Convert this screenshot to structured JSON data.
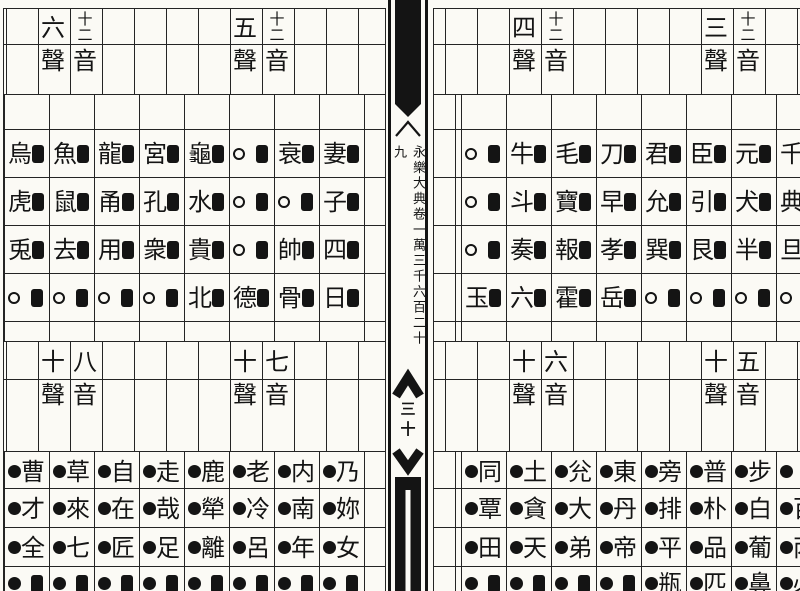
{
  "spine": {
    "volume_title": "永樂大典卷一萬三千六百二十九",
    "page_number": "三十"
  },
  "tables": [
    {
      "id": "sheng3",
      "quadrant": "top-far-right",
      "header_right": "十二音",
      "header_left": "三聲",
      "rows": [
        [
          "君■",
          "臣■",
          "元■",
          "千■"
        ],
        [
          "允■",
          "引■",
          "犬■",
          "典■"
        ],
        [
          "巽■",
          "艮■",
          "半■",
          "旦■"
        ],
        [
          "○■",
          "○■",
          "○■",
          "○■"
        ]
      ]
    },
    {
      "id": "sheng4",
      "quadrant": "top-mid-right",
      "header_right": "十二音",
      "header_left": "四聲",
      "rows": [
        [
          "○■",
          "牛■",
          "毛■",
          "刀■"
        ],
        [
          "○■",
          "斗■",
          "寶■",
          "早■"
        ],
        [
          "○■",
          "奏■",
          "報■",
          "孝■"
        ],
        [
          "玉■",
          "六■",
          "霍■",
          "岳■"
        ]
      ]
    },
    {
      "id": "sheng5",
      "quadrant": "top-mid-left",
      "header_right": "十二音",
      "header_left": "五聲",
      "rows": [
        [
          "龜■",
          "○■",
          "衰■",
          "妻■"
        ],
        [
          "水■",
          "○■",
          "○■",
          "子■"
        ],
        [
          "貴■",
          "○■",
          "帥■",
          "四■"
        ],
        [
          "北■",
          "德■",
          "骨■",
          "日■"
        ]
      ]
    },
    {
      "id": "sheng6",
      "quadrant": "top-far-left",
      "header_right": "十二音",
      "header_left": "六聲",
      "rows": [
        [
          "烏■",
          "魚■",
          "龍■",
          "宮■"
        ],
        [
          "虎■",
          "鼠■",
          "甬■",
          "孔■"
        ],
        [
          "兎■",
          "去■",
          "用■",
          "衆■"
        ],
        [
          "○■",
          "○■",
          "○■",
          "○■"
        ]
      ]
    },
    {
      "id": "yin5",
      "quadrant": "bottom-far-right",
      "header_right": "五音",
      "header_left": "十聲",
      "rows": [
        [
          "●旁",
          "●普",
          "●步",
          "●卜"
        ],
        [
          "●排",
          "●朴",
          "●白",
          "●百"
        ],
        [
          "●平",
          "●品",
          "●葡",
          "●丙"
        ],
        [
          "●瓶",
          "●匹",
          "●鼻",
          "●必"
        ]
      ]
    },
    {
      "id": "yin6",
      "quadrant": "bottom-mid-right",
      "header_right": "六音",
      "header_left": "十聲",
      "rows": [
        [
          "●同",
          "●土",
          "●兊",
          "●東"
        ],
        [
          "●覃",
          "●貪",
          "●大",
          "●丹"
        ],
        [
          "●田",
          "●天",
          "●弟",
          "●帝"
        ],
        [
          "●■",
          "●■",
          "●■",
          "●■"
        ]
      ]
    },
    {
      "id": "yin7",
      "quadrant": "bottom-mid-left",
      "header_right": "七音",
      "header_left": "十聲",
      "rows": [
        [
          "●鹿",
          "●老",
          "●内",
          "●乃"
        ],
        [
          "●犖",
          "●冷",
          "●南",
          "●妳"
        ],
        [
          "●離",
          "●呂",
          "●年",
          "●女"
        ],
        [
          "●■",
          "●■",
          "●■",
          "●■"
        ]
      ]
    },
    {
      "id": "yin8",
      "quadrant": "bottom-far-left",
      "header_right": "八音",
      "header_left": "十聲",
      "rows": [
        [
          "●曹",
          "●草",
          "●自",
          "●走"
        ],
        [
          "●才",
          "●來",
          "●在",
          "●哉"
        ],
        [
          "●全",
          "●七",
          "●匠",
          "●足"
        ],
        [
          "●■",
          "●■",
          "●■",
          "●■"
        ]
      ]
    }
  ],
  "colors": {
    "ink": "#141414",
    "paper": "#fbfaf5",
    "grid_line": "#242424"
  }
}
